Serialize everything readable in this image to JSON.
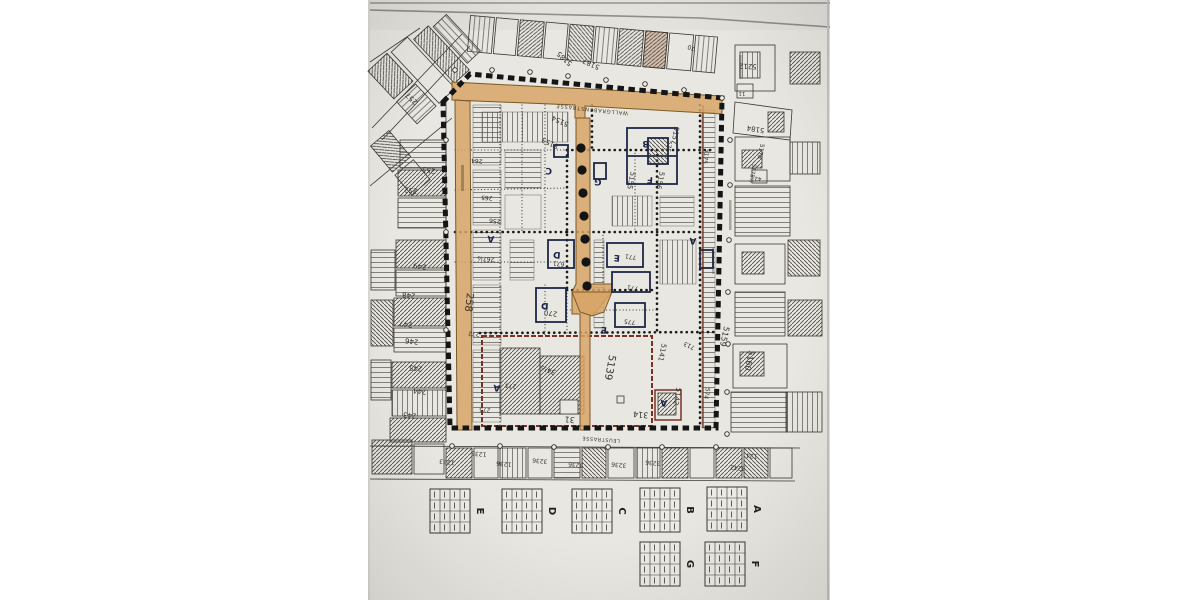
{
  "photo": {
    "background_color": "#ffffff",
    "paper_color": "#e9e7e1",
    "paper_edge_color": "#8f8d89",
    "description_colors": {
      "ink": "#3b3833",
      "highlight_orange": "#d8a566",
      "boundary_black": "#151515",
      "maroon": "#7c3024",
      "building_navy": "#1d2747"
    }
  },
  "map": {
    "street_labels": [
      {
        "label": "WALLGRABENSTRASSE",
        "x": 592,
        "y": 108,
        "rot": 186,
        "size": 5.2,
        "color": "#4a3b20",
        "spacing": 0.8
      },
      {
        "label": "LEUSTRASSE",
        "x": 601,
        "y": 438,
        "rot": 184,
        "size": 5,
        "color": "#3a3833",
        "spacing": 0.6
      }
    ],
    "zone_labels": [
      {
        "label": "C",
        "x": 549,
        "y": 168
      },
      {
        "label": "B",
        "x": 646,
        "y": 141
      },
      {
        "label": "F",
        "x": 650,
        "y": 177
      },
      {
        "label": "G",
        "x": 598,
        "y": 179
      },
      {
        "label": "A",
        "x": 491,
        "y": 236
      },
      {
        "label": "A",
        "x": 693,
        "y": 238
      },
      {
        "label": "D",
        "x": 557,
        "y": 252
      },
      {
        "label": "E",
        "x": 617,
        "y": 255
      },
      {
        "label": "D",
        "x": 545,
        "y": 303
      },
      {
        "label": "E",
        "x": 604,
        "y": 327
      },
      {
        "label": "A",
        "x": 497,
        "y": 385
      },
      {
        "label": "A",
        "x": 664,
        "y": 400
      }
    ],
    "parcel_numbers": [
      {
        "label": "5185",
        "x": 566,
        "y": 57,
        "rot": 222
      },
      {
        "label": "5187",
        "x": 592,
        "y": 62,
        "rot": 205
      },
      {
        "label": "70",
        "x": 692,
        "y": 46,
        "rot": 200,
        "size": 6
      },
      {
        "label": "5212",
        "x": 748,
        "y": 64,
        "rot": 183
      },
      {
        "label": "11",
        "x": 742,
        "y": 92,
        "rot": 182,
        "size": 5.5
      },
      {
        "label": "5184",
        "x": 756,
        "y": 127,
        "rot": 190
      },
      {
        "label": "5178",
        "x": 759,
        "y": 151,
        "rot": 100,
        "size": 6
      },
      {
        "label": "5178½",
        "x": 751,
        "y": 173,
        "rot": 100,
        "size": 5.5
      },
      {
        "label": "42",
        "x": 758,
        "y": 177,
        "rot": 182,
        "size": 5.5
      },
      {
        "label": "257",
        "x": 413,
        "y": 97,
        "rot": 222
      },
      {
        "label": "253",
        "x": 429,
        "y": 168,
        "rot": 190
      },
      {
        "label": "252",
        "x": 411,
        "y": 188,
        "rot": 188
      },
      {
        "label": "249",
        "x": 420,
        "y": 264,
        "rot": 186
      },
      {
        "label": "248",
        "x": 409,
        "y": 293,
        "rot": 186
      },
      {
        "label": "247",
        "x": 406,
        "y": 322,
        "rot": 186
      },
      {
        "label": "246",
        "x": 412,
        "y": 339,
        "rot": 186
      },
      {
        "label": "245",
        "x": 416,
        "y": 366,
        "rot": 186
      },
      {
        "label": "244",
        "x": 420,
        "y": 389,
        "rot": 186
      },
      {
        "label": "243",
        "x": 410,
        "y": 413,
        "rot": 186
      },
      {
        "label": "264",
        "x": 477,
        "y": 159,
        "rot": 185,
        "size": 6
      },
      {
        "label": "265",
        "x": 487,
        "y": 196,
        "rot": 185,
        "size": 6
      },
      {
        "label": "256",
        "x": 495,
        "y": 219,
        "rot": 185,
        "size": 6
      },
      {
        "label": "267½",
        "x": 486,
        "y": 257,
        "rot": 185,
        "size": 6
      },
      {
        "label": "272",
        "x": 474,
        "y": 332,
        "rot": 185,
        "size": 6
      },
      {
        "label": "273",
        "x": 511,
        "y": 384,
        "rot": 185,
        "size": 6
      },
      {
        "label": "275",
        "x": 485,
        "y": 408,
        "rot": 185,
        "size": 6
      },
      {
        "label": "258",
        "x": 466,
        "y": 302,
        "rot": 96,
        "size": 10
      },
      {
        "label": "5139",
        "x": 607,
        "y": 367,
        "rot": 100,
        "size": 10
      },
      {
        "label": "34½",
        "x": 549,
        "y": 368,
        "rot": 200
      },
      {
        "label": "31",
        "x": 570,
        "y": 417,
        "rot": 186,
        "size": 8
      },
      {
        "label": "314",
        "x": 641,
        "y": 412,
        "rot": 186,
        "size": 8
      },
      {
        "label": "5141",
        "x": 660,
        "y": 352,
        "rot": 102
      },
      {
        "label": "713",
        "x": 690,
        "y": 344,
        "rot": 205,
        "size": 6
      },
      {
        "label": "5142",
        "x": 675,
        "y": 396,
        "rot": 100
      },
      {
        "label": "574",
        "x": 705,
        "y": 393,
        "rot": 100,
        "size": 6
      },
      {
        "label": "5159",
        "x": 722,
        "y": 336,
        "rot": 102,
        "size": 8
      },
      {
        "label": "5160",
        "x": 747,
        "y": 360,
        "rot": 102,
        "size": 8
      },
      {
        "label": "5154",
        "x": 561,
        "y": 119,
        "rot": 205
      },
      {
        "label": "5153",
        "x": 551,
        "y": 141,
        "rot": 205
      },
      {
        "label": "5157",
        "x": 673,
        "y": 135,
        "rot": 100
      },
      {
        "label": "575",
        "x": 667,
        "y": 146,
        "rot": 100,
        "size": 6
      },
      {
        "label": "5175",
        "x": 704,
        "y": 156,
        "rot": 100,
        "size": 6
      },
      {
        "label": "5156",
        "x": 658,
        "y": 180,
        "rot": 102
      },
      {
        "label": "5155",
        "x": 629,
        "y": 180,
        "rot": 102
      },
      {
        "label": "771",
        "x": 631,
        "y": 255,
        "rot": 188,
        "size": 6
      },
      {
        "label": "671",
        "x": 559,
        "y": 262,
        "rot": 188,
        "size": 6
      },
      {
        "label": "771",
        "x": 633,
        "y": 286,
        "rot": 188,
        "size": 6
      },
      {
        "label": "775",
        "x": 630,
        "y": 320,
        "rot": 188,
        "size": 6
      },
      {
        "label": "270",
        "x": 551,
        "y": 311,
        "rot": 188
      },
      {
        "label": "1233",
        "x": 447,
        "y": 460,
        "rot": 186,
        "size": 6
      },
      {
        "label": "1235",
        "x": 479,
        "y": 452,
        "rot": 186,
        "size": 6
      },
      {
        "label": "1236",
        "x": 504,
        "y": 462,
        "rot": 186,
        "size": 6
      },
      {
        "label": "3236",
        "x": 540,
        "y": 459,
        "rot": 186,
        "size": 6
      },
      {
        "label": "3236",
        "x": 576,
        "y": 463,
        "rot": 186,
        "size": 6
      },
      {
        "label": "3236",
        "x": 619,
        "y": 463,
        "rot": 186,
        "size": 6
      },
      {
        "label": "3236",
        "x": 653,
        "y": 461,
        "rot": 186,
        "size": 6
      },
      {
        "label": "3242",
        "x": 738,
        "y": 466,
        "rot": 186,
        "size": 6
      },
      {
        "label": "124",
        "x": 752,
        "y": 454,
        "rot": 186,
        "size": 6
      }
    ],
    "path_dots": {
      "x_start": 581,
      "x_step": 1,
      "radius": 4.6,
      "ys": [
        148,
        170,
        193,
        216,
        239,
        262,
        286
      ]
    }
  },
  "legend_tables": [
    {
      "label": "E",
      "x": 430,
      "y": 489
    },
    {
      "label": "D",
      "x": 502,
      "y": 489
    },
    {
      "label": "C",
      "x": 572,
      "y": 489
    },
    {
      "label": "B",
      "x": 640,
      "y": 488
    },
    {
      "label": "A",
      "x": 707,
      "y": 487
    },
    {
      "label": "G",
      "x": 640,
      "y": 542
    },
    {
      "label": "F",
      "x": 705,
      "y": 542
    }
  ]
}
